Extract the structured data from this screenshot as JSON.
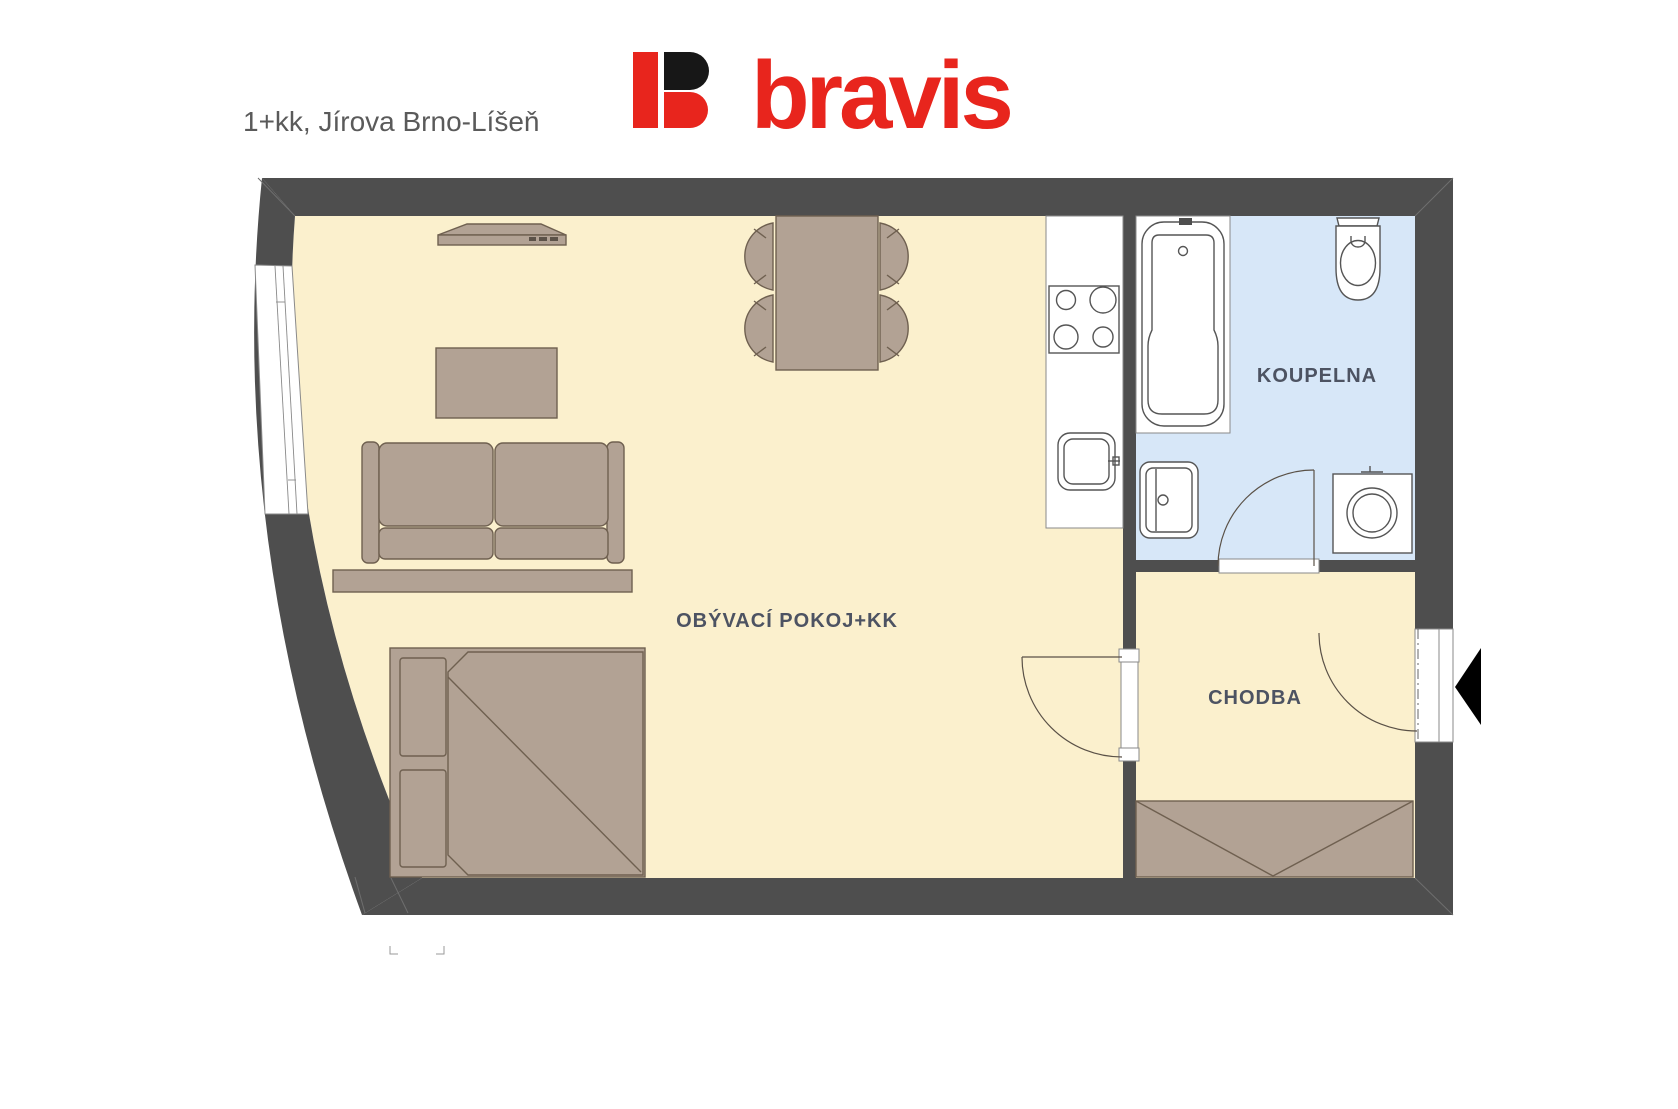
{
  "page": {
    "title": "1+kk, Jírova Brno-Líšeň",
    "background": "#ffffff"
  },
  "logo": {
    "text": "bravis",
    "red": "#e8251d",
    "black": "#171717"
  },
  "floorplan": {
    "rooms": [
      {
        "id": "living-room",
        "label": "OBÝVACÍ POKOJ+KK",
        "fill": "#fbf0cd"
      },
      {
        "id": "bathroom",
        "label": "KOUPELNA",
        "fill": "#d7e7f8"
      },
      {
        "id": "hallway",
        "label": "CHODBA",
        "fill": "#fbf0cd"
      }
    ],
    "colors": {
      "wall": "#4e4e4e",
      "furniture": "#b2a294",
      "furniture_stroke": "#6f6050",
      "fixture_stroke": "#555555",
      "label": "#4d5362"
    },
    "fixtures": [
      "tv",
      "coffee-table",
      "sofa",
      "bed",
      "dining-table",
      "chairs",
      "kitchen-counter",
      "stove",
      "kitchen-sink",
      "bathtub",
      "washbasin",
      "toilet",
      "washing-machine",
      "wardrobe",
      "window",
      "entrance-door",
      "bathroom-door",
      "living-room-door",
      "entrance-arrow"
    ]
  }
}
